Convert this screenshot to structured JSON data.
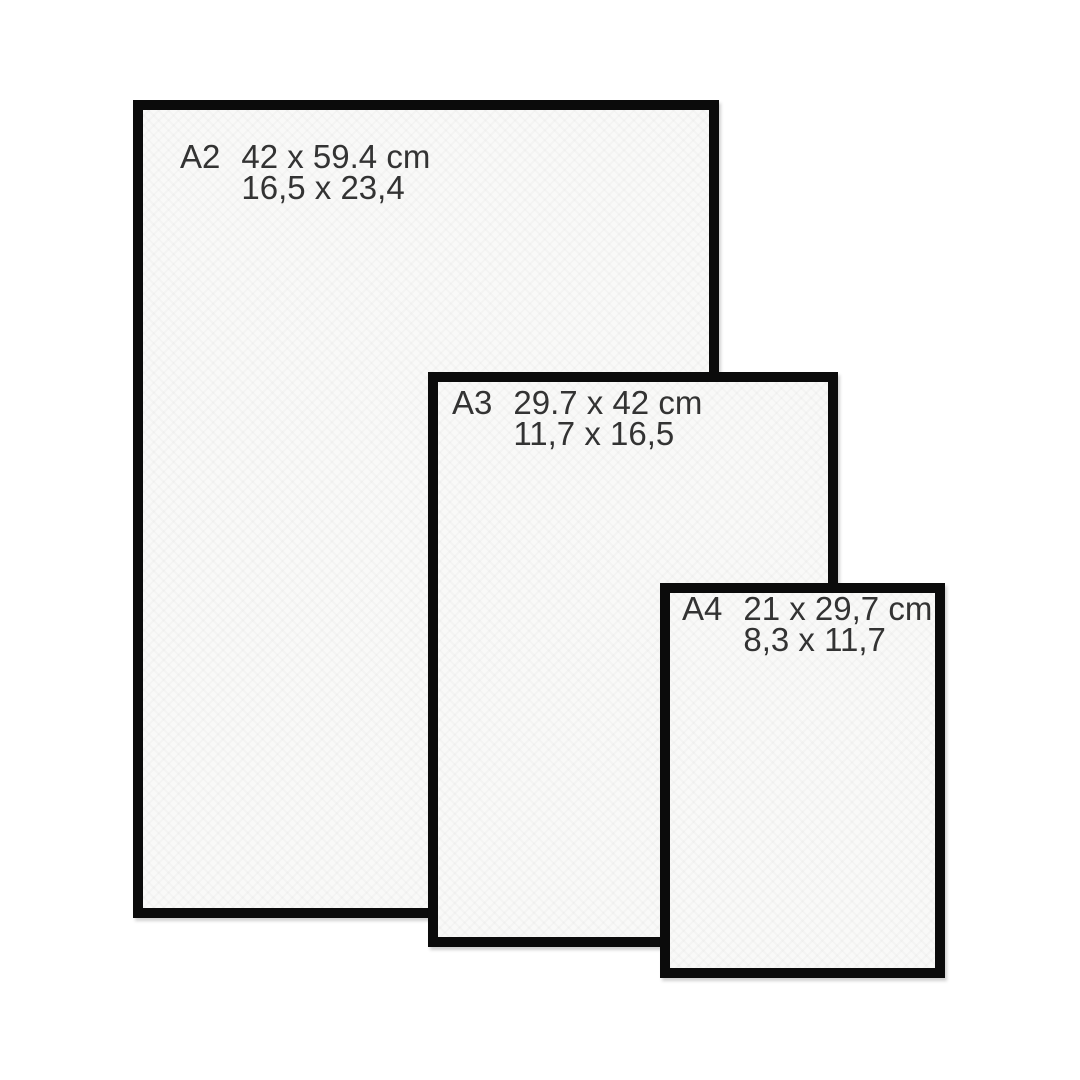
{
  "title": "Paper size comparison chart",
  "frames": [
    {
      "code": "A2",
      "cm": "42 x 59.4 cm",
      "inches": "16,5 x 23,4"
    },
    {
      "code": "A3",
      "cm": "29.7 x 42 cm",
      "inches": "11,7 x 16,5"
    },
    {
      "code": "A4",
      "cm": "21 x 29,7 cm",
      "inches": "8,3 x 11,7"
    }
  ],
  "colors": {
    "frame_border": "#0b0b0b",
    "paper": "#f9f9f8",
    "text": "#333333",
    "background": "#ffffff"
  }
}
